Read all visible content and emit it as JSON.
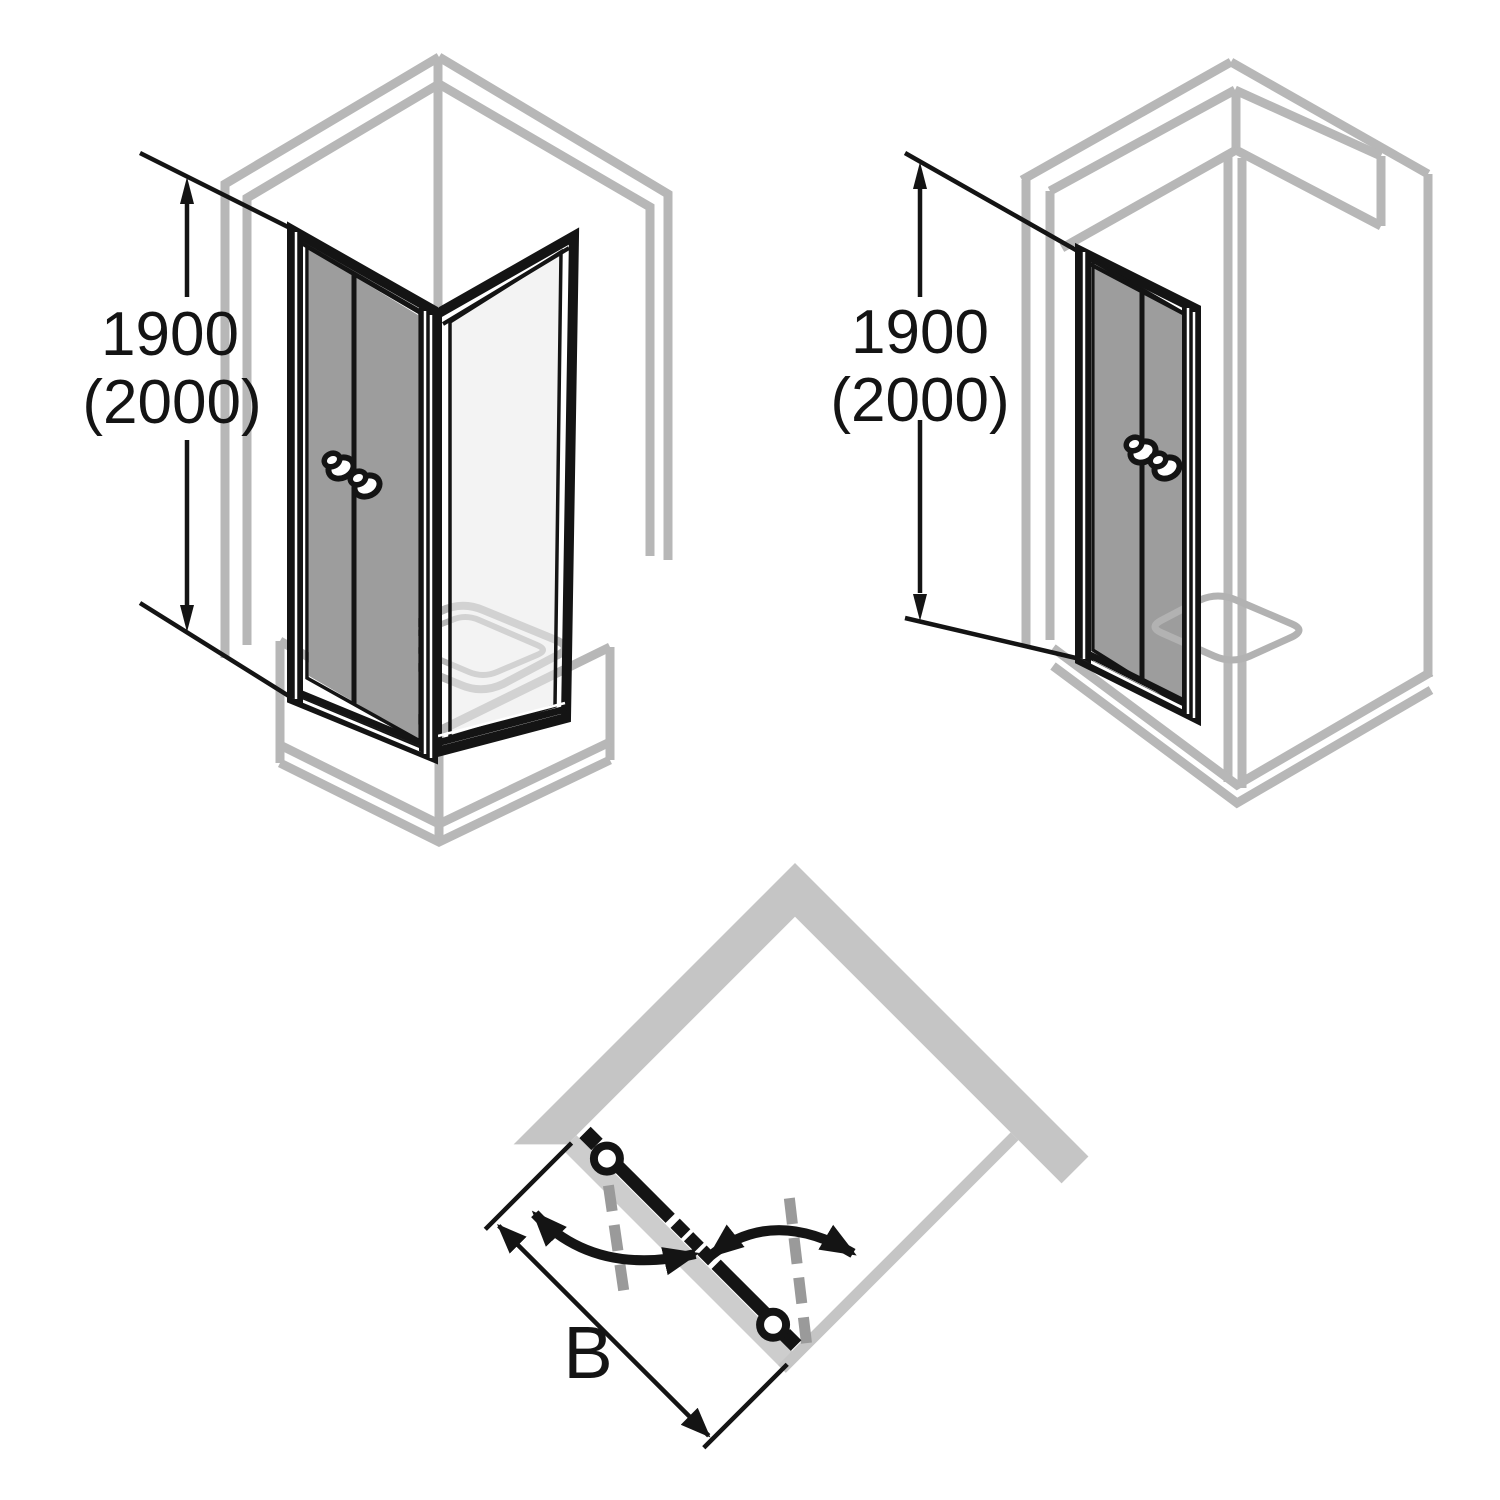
{
  "figure": {
    "type": "technical-installation-diagram",
    "background": "#ffffff",
    "colors": {
      "line_black": "#141414",
      "outline_gray": "#b7b7b7",
      "plan_wall_fill": "#c5c5c5",
      "plan_track_fill": "#cdcdcd",
      "swing_axis_dash_gray": "#9a9a9a",
      "door_glass": "#9d9d9d",
      "side_glass": "#e9e9e9"
    },
    "views": {
      "corner_entry": {
        "name": "corner installation isometric view",
        "height_label_primary": "1900",
        "height_label_secondary": "(2000)"
      },
      "niche_entry": {
        "name": "niche installation isometric view",
        "height_label_primary": "1900",
        "height_label_secondary": "(2000)"
      },
      "plan_swing": {
        "name": "top-down pendulum door swing plan",
        "width_label": "B"
      }
    }
  }
}
